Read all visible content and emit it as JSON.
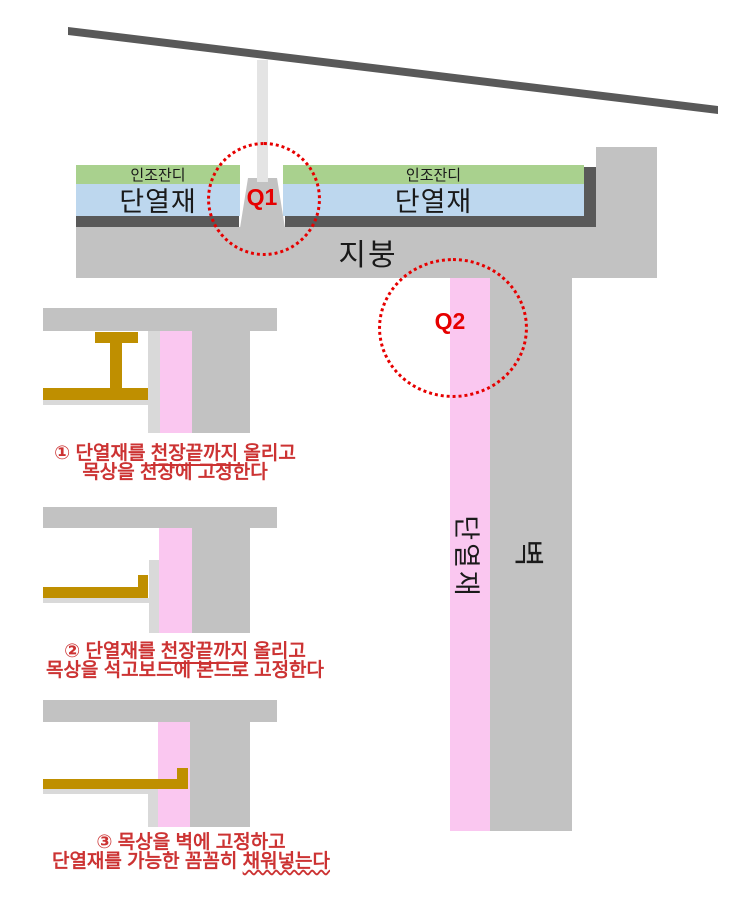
{
  "colors": {
    "turf-green": "#a9d18e",
    "insulation-blue": "#bdd7ee",
    "insulation-pink": "#fac7f0",
    "concrete-gray": "#c2c2c2",
    "membrane-dark": "#595959",
    "post-gray": "#e4e4e4",
    "board-gray": "#d9d9d9",
    "furring-gold": "#bf8f00",
    "annotation-red": "#e60000",
    "caption-red": "#cc3333",
    "text-black": "#1a1a1a"
  },
  "main_diagram": {
    "turf_label": "인조잔디",
    "roof_insulation_label": "단열재",
    "roof_label": "지붕",
    "wall_label": "벽",
    "wall_insulation_label": "단열재",
    "q1_label": "Q1",
    "q2_label": "Q2"
  },
  "steps": [
    {
      "line1": {
        "pre": "① 단열재를 ",
        "underlined": "천장끝까지",
        "post": " 올리고"
      },
      "line2": {
        "pre": "목상을 천장에 고정한다",
        "underlined": "",
        "post": ""
      }
    },
    {
      "line1": {
        "pre": "② 단열재를 ",
        "underlined": "천장끝까지",
        "post": " 올리고"
      },
      "line2": {
        "pre": "목상을 석고보드에 본드로 고정한다",
        "underlined": "",
        "post": ""
      }
    },
    {
      "line1": {
        "pre": "③ 목상을 벽에 고정하고",
        "underlined": "",
        "post": ""
      },
      "line2": {
        "pre": "단열재를 가능한 꼼꼼히 ",
        "underlined": "채워넣는다",
        "post": ""
      }
    }
  ]
}
